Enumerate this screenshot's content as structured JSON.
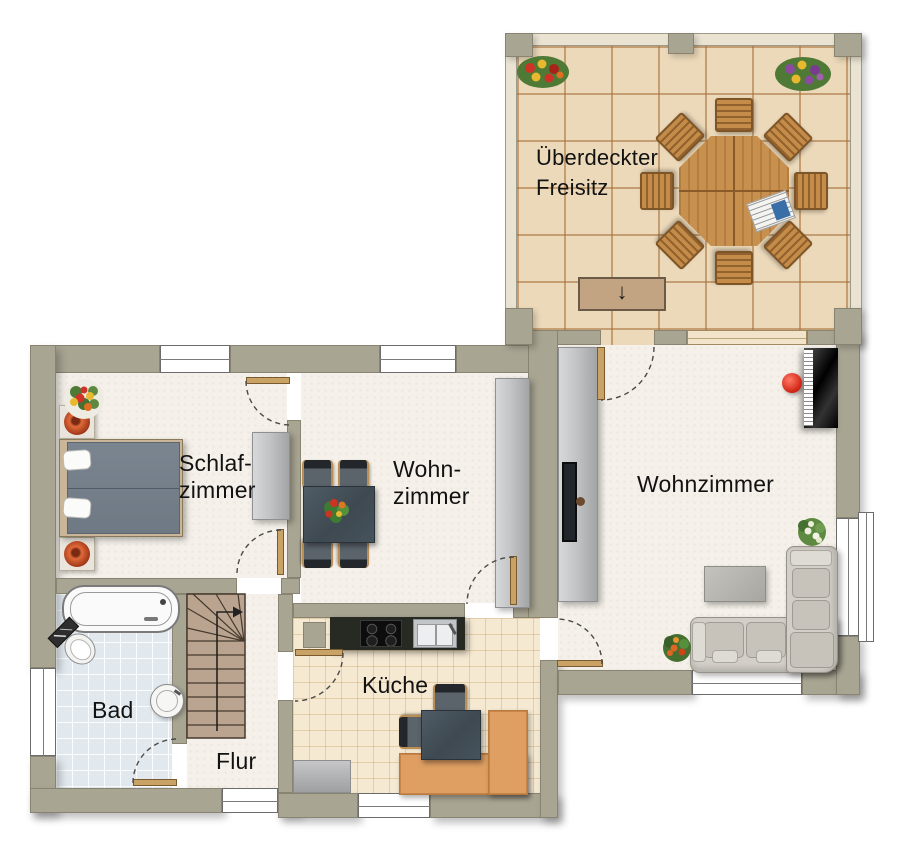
{
  "rooms": [
    {
      "id": "freisitz",
      "label": "Überdeckter\nFreisitz",
      "furniture": [
        "octagonal-garden-table",
        "garden-chair-x8",
        "newspaper",
        "flower-bed-left",
        "flower-bed-right",
        "terrace-steps"
      ]
    },
    {
      "id": "schlafzimmer",
      "label": "Schlaf-\nzimmer",
      "furniture": [
        "double-bed",
        "nightstand-top",
        "nightstand-bottom",
        "plant-pot-top",
        "plant-pot-bottom",
        "flower-bouquet",
        "wardrobe"
      ]
    },
    {
      "id": "wohnzimmer-klein",
      "label": "Wohn-\nzimmer",
      "furniture": [
        "dining-table",
        "dining-chair-x4",
        "flower-centerpiece",
        "sideboard"
      ]
    },
    {
      "id": "wohnzimmer",
      "label": "Wohnzimmer",
      "furniture": [
        "wall-unit",
        "tv",
        "piano",
        "piano-stool",
        "corner-sofa",
        "coffee-table",
        "white-plant",
        "orange-plant"
      ]
    },
    {
      "id": "bad",
      "label": "Bad",
      "furniture": [
        "bathtub",
        "toilet",
        "washbasin"
      ]
    },
    {
      "id": "kueche",
      "label": "Küche",
      "furniture": [
        "kitchen-counter",
        "stove",
        "sink",
        "chimney",
        "corner-bench",
        "kitchen-table",
        "kitchen-chair-x2",
        "rug"
      ]
    },
    {
      "id": "flur",
      "label": "Flur",
      "furniture": [
        "staircase"
      ]
    }
  ],
  "symbols": {
    "steps_down_arrow": "↓",
    "stairs_direction": "up-then-right"
  },
  "colors": {
    "wall": "#a9a593",
    "terrace_tile": "#ecd9ba",
    "bath_tile": "#e1e9ef",
    "kitchen_tile": "#f5e9d2",
    "carpet": "#f5f1ea",
    "bench_orange": "#df9f63",
    "table_dark": "#46525c",
    "sofa_gray": "#d3cfc8",
    "piano_black": "#000000",
    "stool_red": "#d42818",
    "door_wood": "#c9a265",
    "stair_wood": "#baa38f"
  }
}
